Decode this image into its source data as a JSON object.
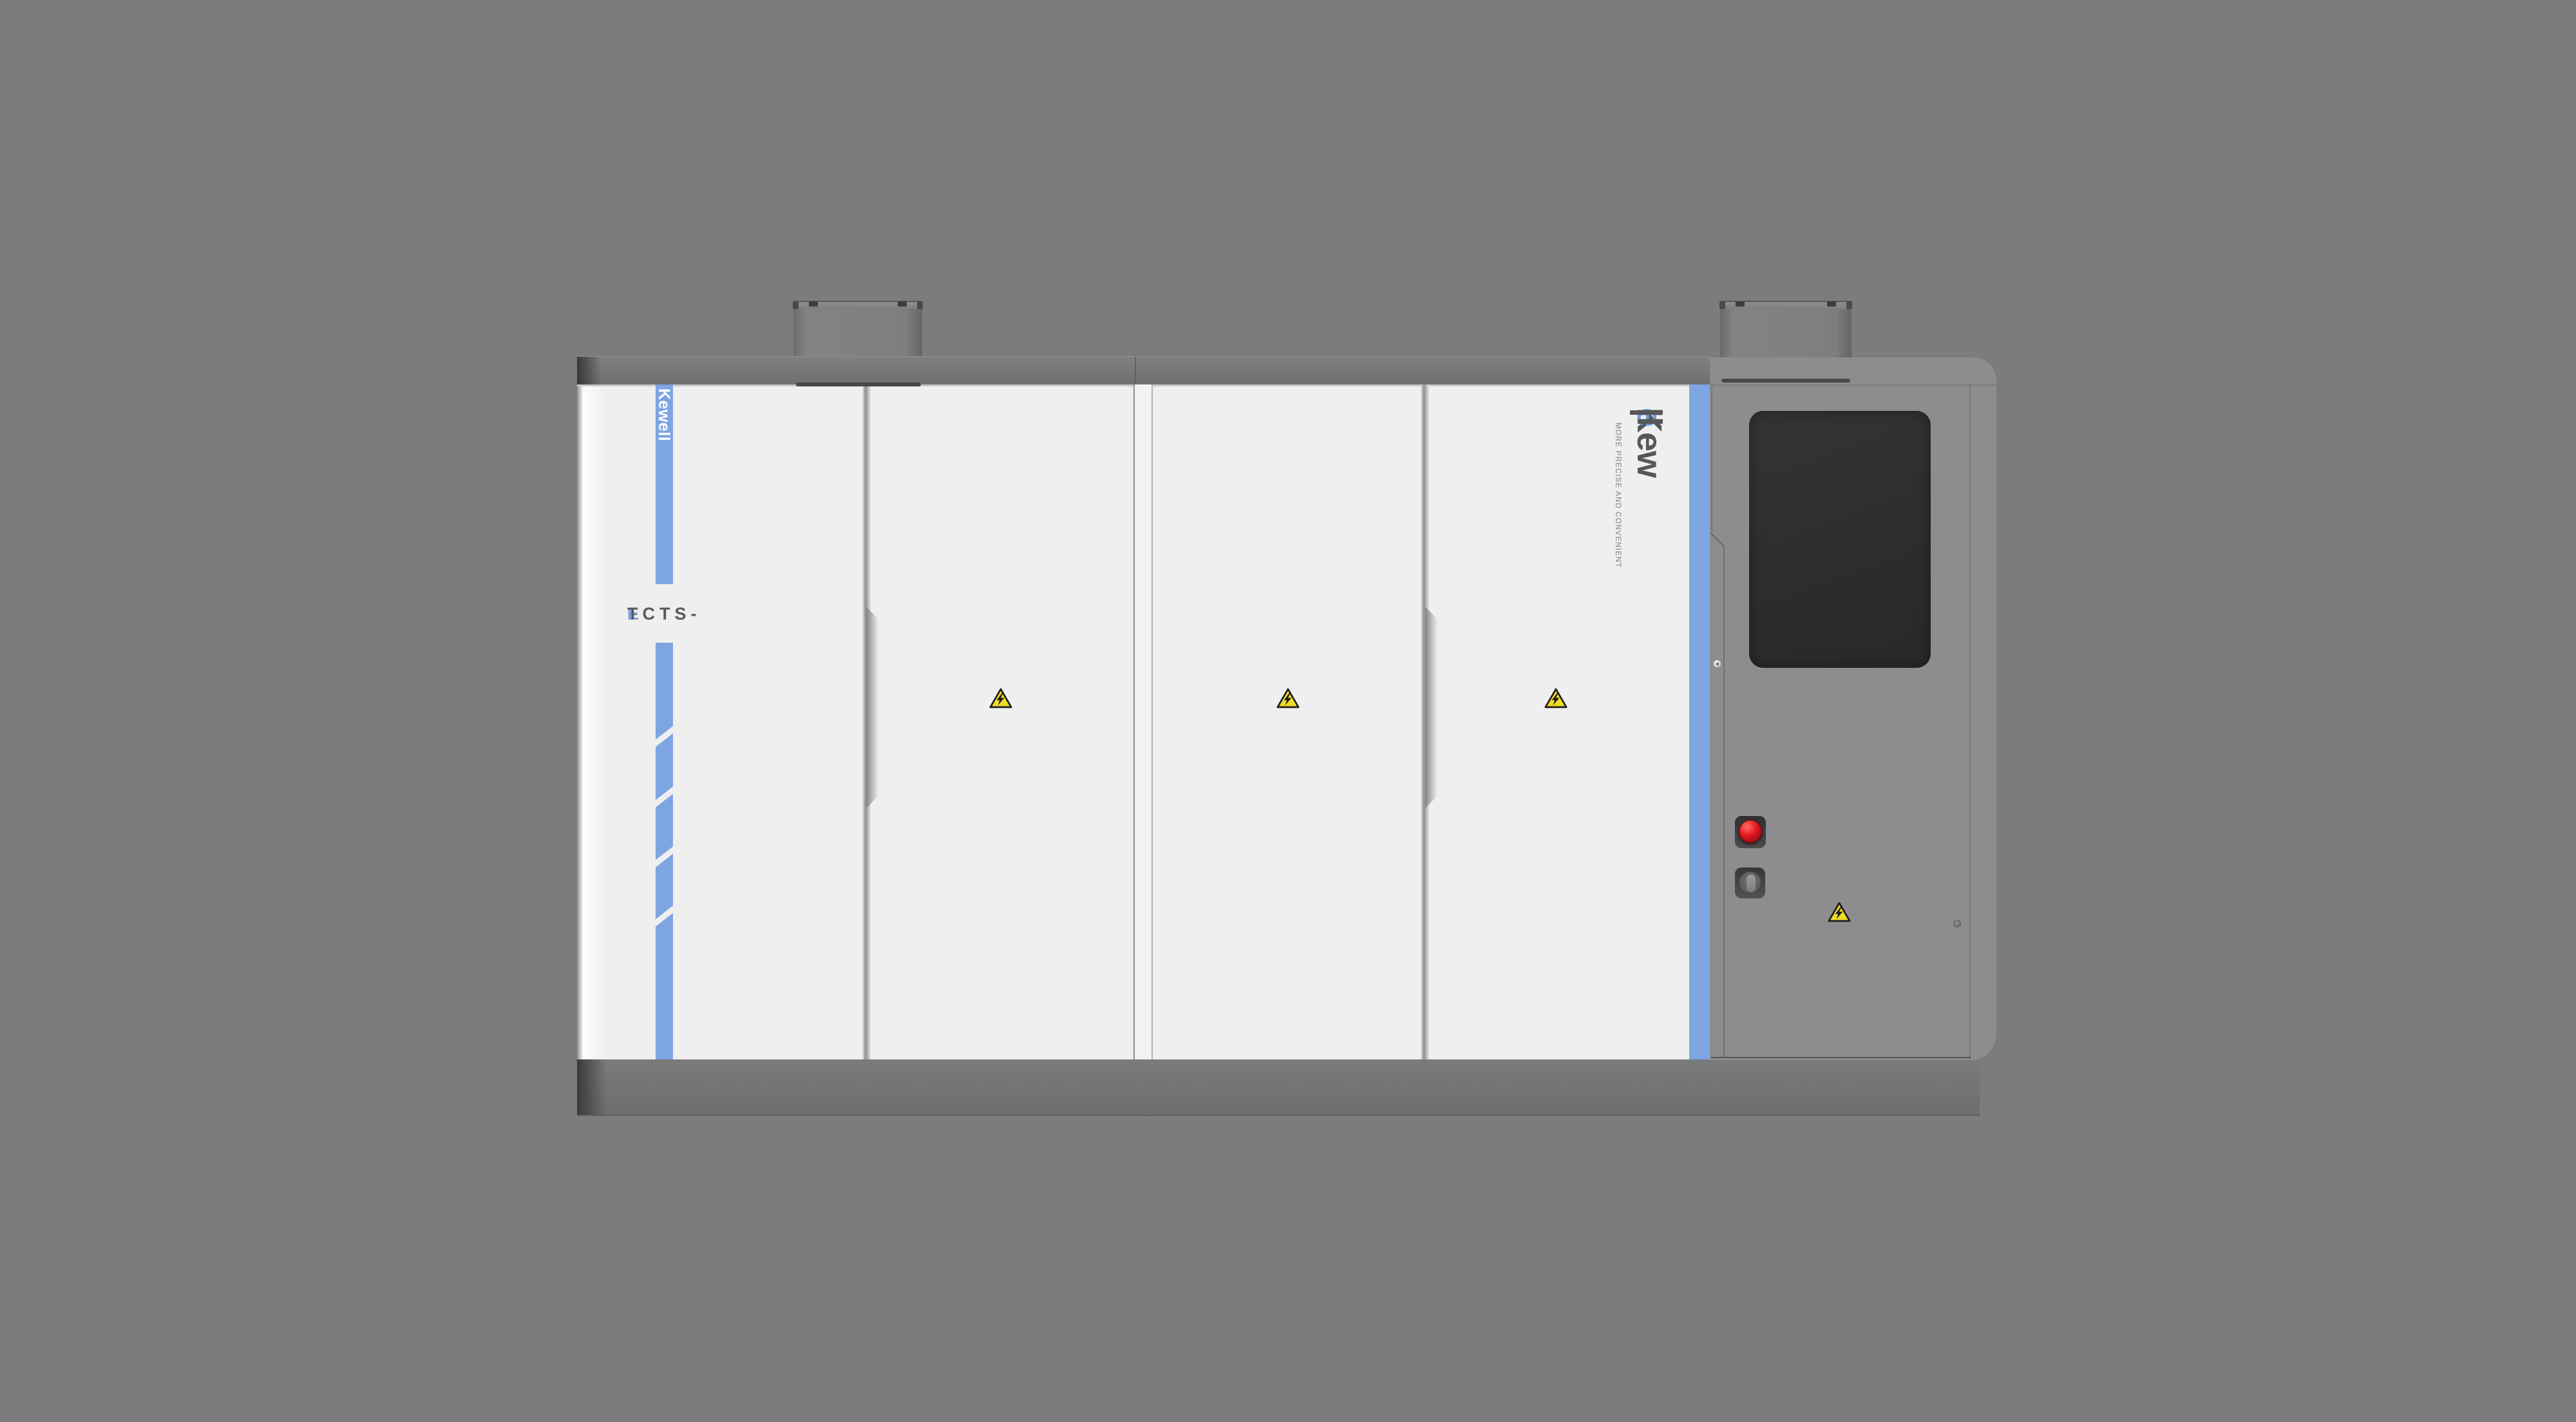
{
  "machine": {
    "name": "industrial-test-system-cabinet",
    "left_stripe": {
      "brand_vertical_label": "Kewell"
    },
    "model_label": {
      "prefix": "FCTS-",
      "accent": "E",
      "suffix": "T"
    },
    "logo": {
      "bar": "|",
      "part1": "Kew",
      "accent_letter": "e",
      "part2": "ll",
      "tagline": "MORE PRECISE AND CONVENIENT"
    },
    "icons": {
      "door_warning_1": "high-voltage-warning-triangle",
      "door_warning_2": "high-voltage-warning-triangle",
      "door_warning_3": "high-voltage-warning-triangle",
      "panel_warning": "high-voltage-warning-triangle",
      "emergency_stop": "red-mushroom-emergency-stop",
      "key_switch": "key-switch",
      "touchscreen": "blank-touchscreen-display"
    },
    "colors": {
      "background_gray": "#7c7c7e",
      "cabinet_white": "#efeff0",
      "accent_blue_stripe": "#7CA5E2",
      "accent_blue_logo": "#6C9EE6",
      "logo_gray": "#57575a",
      "frame_rail_gray": "#727274",
      "control_panel_gray": "#8d8d8f",
      "plinth_gray": "#747476",
      "screen_black": "#2c2c2e",
      "warning_yellow": "#EFDC25",
      "estop_red": "#C8131B"
    }
  }
}
